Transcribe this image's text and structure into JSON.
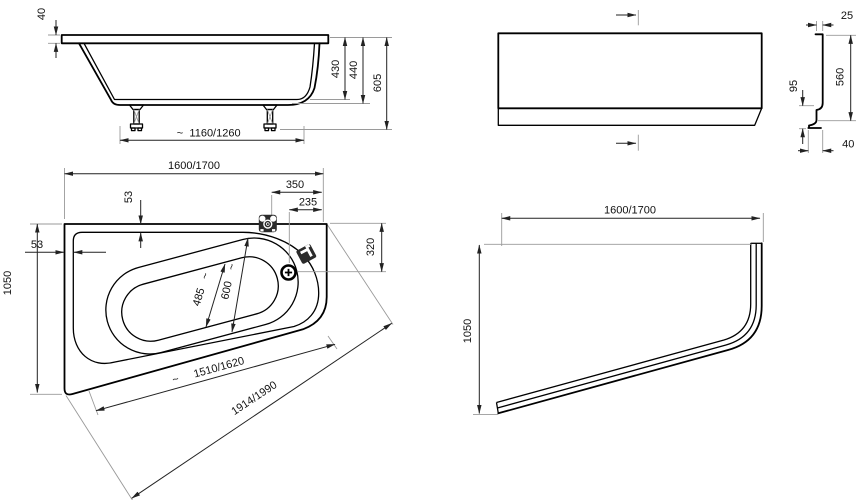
{
  "drawing": {
    "approx_symbol": "~",
    "side_view": {
      "rim_thickness": "40",
      "inner_depth": "430",
      "shell_height": "440",
      "total_height": "605",
      "base_length": "1160/1260"
    },
    "apron_front_view": {
      "top_thickness": "25",
      "height": "560",
      "plinth_height": "95",
      "plinth_recess": "40"
    },
    "plan_view": {
      "length": "1600/1700",
      "tap_offset": "350",
      "drain_offset": "235",
      "rim_width_top": "53",
      "rim_width_left": "53",
      "width": "1050",
      "drain_from_edge": "320",
      "well_width": "600",
      "well_bottom_width": "485",
      "front_edge_length": "1510/1620",
      "diagonal_length": "1914/1990"
    },
    "apron_plan_view": {
      "length": "1600/1700",
      "width": "1050"
    }
  }
}
